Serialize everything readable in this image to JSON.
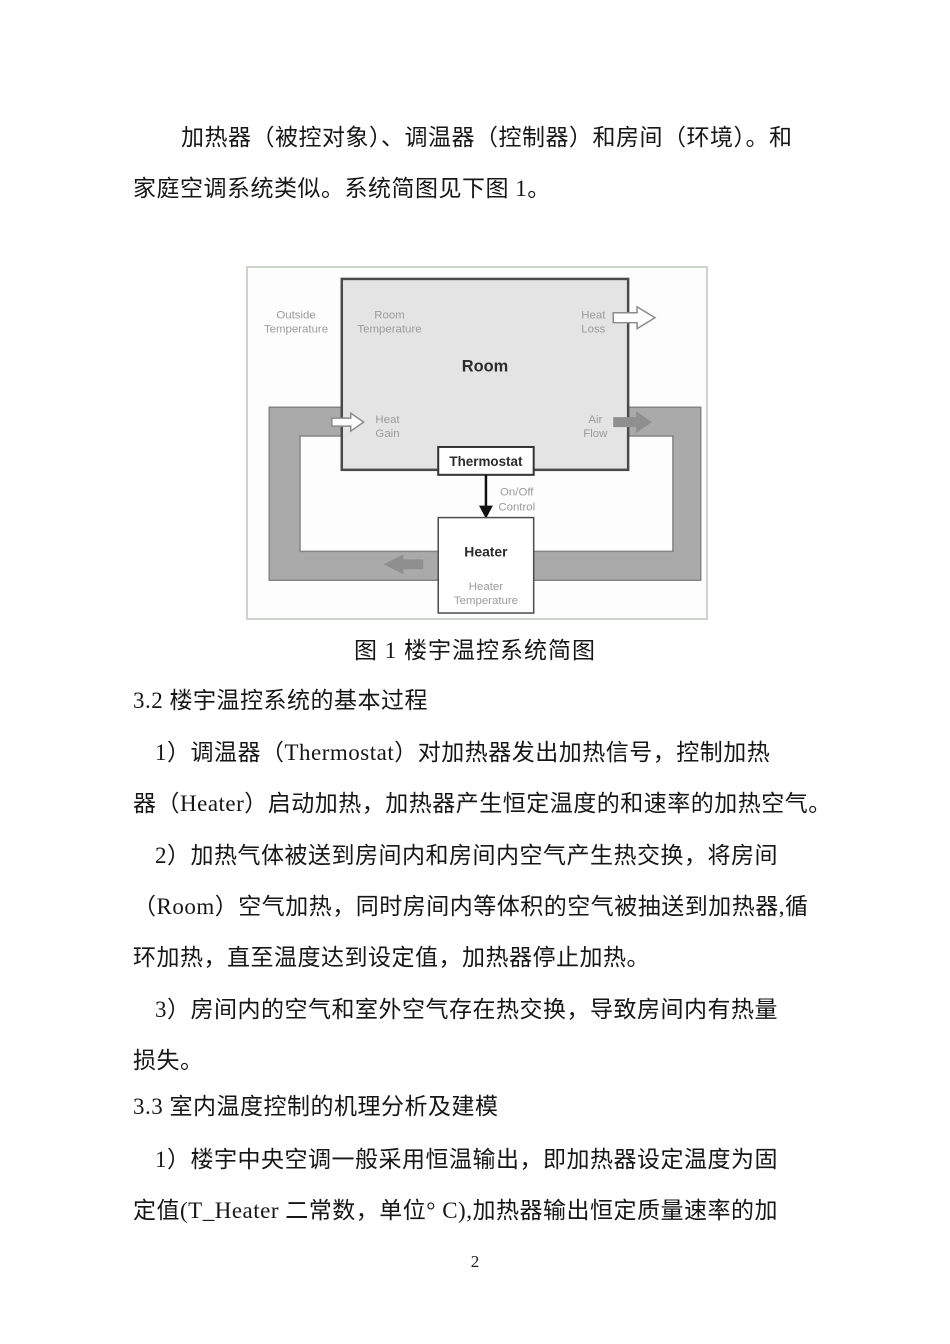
{
  "document": {
    "intro": {
      "line1": "加热器（被控对象）、调温器（控制器）和房间（环境）。和",
      "line2": "家庭空调系统类似。系统简图见下图 1。"
    },
    "figure_caption": "图 1 楼宇温控系统简图",
    "heading_3_2": "3.2 楼宇温控系统的基本过程",
    "item1": {
      "line1": "1）调温器（Thermostat）对加热器发出加热信号，控制加热",
      "line2": "器（Heater）启动加热，加热器产生恒定温度的和速率的加热空气。"
    },
    "item2": {
      "line1": "2）加热气体被送到房间内和房间内空气产生热交换，将房间",
      "line2": "（Room）空气加热，同时房间内等体积的空气被抽送到加热器,循",
      "line3": "环加热，直至温度达到设定值，加热器停止加热。"
    },
    "item3": {
      "line1": "3）房间内的空气和室外空气存在热交换，导致房间内有热量",
      "line2": "损失。"
    },
    "heading_3_3": "3.3 室内温度控制的机理分析及建模",
    "item4": {
      "line1": "1）楼宇中央空调一般采用恒温输出，即加热器设定温度为固",
      "line2": "定值(T_Heater 二常数，单位° C),加热器输出恒定质量速率的加"
    },
    "page_number": "2"
  },
  "diagram": {
    "room_label": "Room",
    "thermostat_label": "Thermostat",
    "heater_label": "Heater",
    "outside_temperature": [
      "Outside",
      "Temperature"
    ],
    "room_temperature": [
      "Room",
      "Temperature"
    ],
    "heat_loss": [
      "Heat",
      "Loss"
    ],
    "heat_gain": [
      "Heat",
      "Gain"
    ],
    "air_flow": [
      "Air",
      "Flow"
    ],
    "on_off_control": [
      "On/Off",
      "Control"
    ],
    "heater_temperature": [
      "Heater",
      "Temperature"
    ],
    "colors": {
      "duct_fill": "#aaaaaa",
      "duct_stroke": "#858585",
      "room_fill": "#e4e4e4",
      "room_stroke": "#4a4a4a",
      "gray_arrow": "#8f8f8f",
      "label_gray": "#9b9b9b",
      "frame_border": "#ccd4cb"
    }
  }
}
